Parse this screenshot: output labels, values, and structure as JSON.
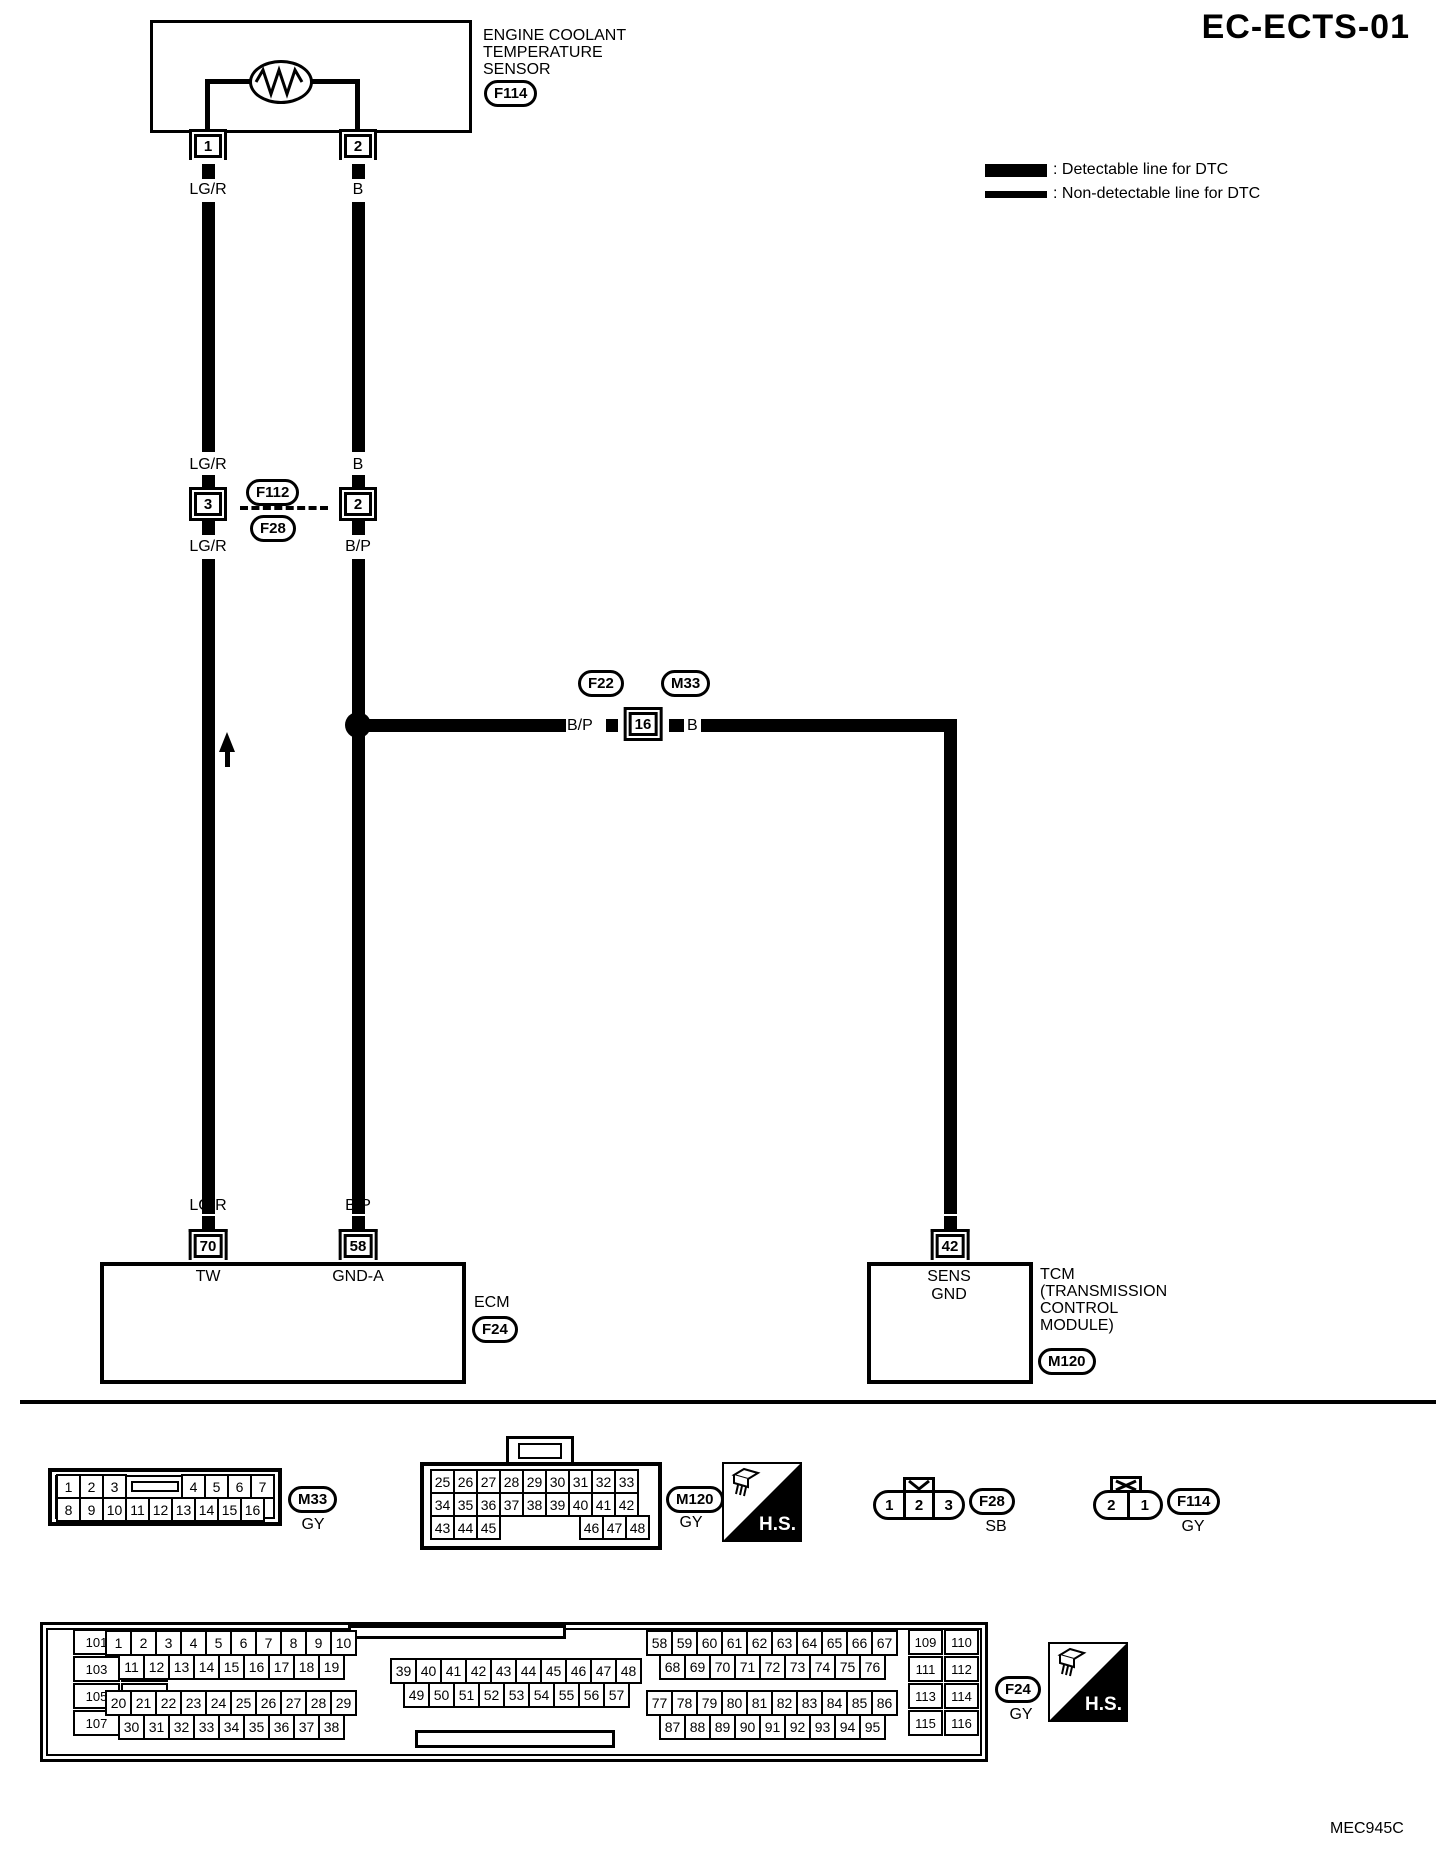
{
  "title": "EC-ECTS-01",
  "figure_code": "MEC945C",
  "legend": {
    "detectable": ": Detectable line for DTC",
    "non_detectable": ": Non-detectable line for DTC"
  },
  "diagram": {
    "sensor": {
      "name_lines": [
        "ENGINE COOLANT",
        "TEMPERATURE",
        "SENSOR"
      ],
      "ref": "F114",
      "pin_left": "1",
      "pin_right": "2",
      "wire_left": "LG/R",
      "wire_right": "B"
    },
    "inline": {
      "ref_top": "F112",
      "ref_bottom": "F28",
      "left_pin": "3",
      "right_pin": "2",
      "left_wire_above": "LG/R",
      "left_wire_below": "LG/R",
      "right_wire_above": "B",
      "right_wire_below": "B/P"
    },
    "branch": {
      "ref_left": "F22",
      "ref_right": "M33",
      "pin": "16",
      "wire_left": "B/P",
      "wire_right": "B"
    },
    "ecm": {
      "label": "ECM",
      "ref": "F24",
      "pin_left": "70",
      "pin_right": "58",
      "pin_left_name": "TW",
      "pin_right_name": "GND-A",
      "wire_left": "LG/R",
      "wire_right": "B/P"
    },
    "tcm": {
      "label_lines": [
        "TCM",
        "(TRANSMISSION",
        "CONTROL",
        "MODULE)"
      ],
      "ref": "M120",
      "pin": "42",
      "pin_name_lines": [
        "SENS",
        "GND"
      ],
      "wire": "B"
    }
  },
  "connector_views": {
    "hs_label": "H.S.",
    "m33": {
      "ref": "M33",
      "color": "GY",
      "row1a": [
        "1",
        "2",
        "3"
      ],
      "row1b": [
        "4",
        "5",
        "6",
        "7"
      ],
      "row2": [
        "8",
        "9",
        "10",
        "11",
        "12",
        "13",
        "14",
        "15",
        "16"
      ]
    },
    "m120": {
      "ref": "M120",
      "color": "GY",
      "row1": [
        "25",
        "26",
        "27",
        "28",
        "29",
        "30",
        "31",
        "32",
        "33"
      ],
      "row2": [
        "34",
        "35",
        "36",
        "37",
        "38",
        "39",
        "40",
        "41",
        "42"
      ],
      "row3a": [
        "43",
        "44",
        "45"
      ],
      "row3b": [
        "46",
        "47",
        "48"
      ]
    },
    "f28": {
      "ref": "F28",
      "color": "SB",
      "cells": [
        "1",
        "2",
        "3"
      ]
    },
    "f114": {
      "ref": "F114",
      "color": "GY",
      "cells": [
        "2",
        "1"
      ]
    },
    "f24": {
      "ref": "F24",
      "color": "GY",
      "left_col": [
        "101",
        "102",
        "103",
        "104",
        "105",
        "106",
        "107",
        "108"
      ],
      "row_a1": [
        "1",
        "2",
        "3",
        "4",
        "5",
        "6",
        "7",
        "8",
        "9",
        "10"
      ],
      "row_a2": [
        "11",
        "12",
        "13",
        "14",
        "15",
        "16",
        "17",
        "18",
        "19"
      ],
      "row_a3": [
        "20",
        "21",
        "22",
        "23",
        "24",
        "25",
        "26",
        "27",
        "28",
        "29"
      ],
      "row_a4": [
        "30",
        "31",
        "32",
        "33",
        "34",
        "35",
        "36",
        "37",
        "38"
      ],
      "row_b1": [
        "39",
        "40",
        "41",
        "42",
        "43",
        "44",
        "45",
        "46",
        "47",
        "48"
      ],
      "row_b2": [
        "49",
        "50",
        "51",
        "52",
        "53",
        "54",
        "55",
        "56",
        "57"
      ],
      "row_d1": [
        "58",
        "59",
        "60",
        "61",
        "62",
        "63",
        "64",
        "65",
        "66",
        "67"
      ],
      "row_d2": [
        "68",
        "69",
        "70",
        "71",
        "72",
        "73",
        "74",
        "75",
        "76"
      ],
      "row_d3": [
        "77",
        "78",
        "79",
        "80",
        "81",
        "82",
        "83",
        "84",
        "85",
        "86"
      ],
      "row_d4": [
        "87",
        "88",
        "89",
        "90",
        "91",
        "92",
        "93",
        "94",
        "95"
      ],
      "right_col": [
        "109",
        "110",
        "111",
        "112",
        "113",
        "114",
        "115",
        "116"
      ]
    }
  }
}
